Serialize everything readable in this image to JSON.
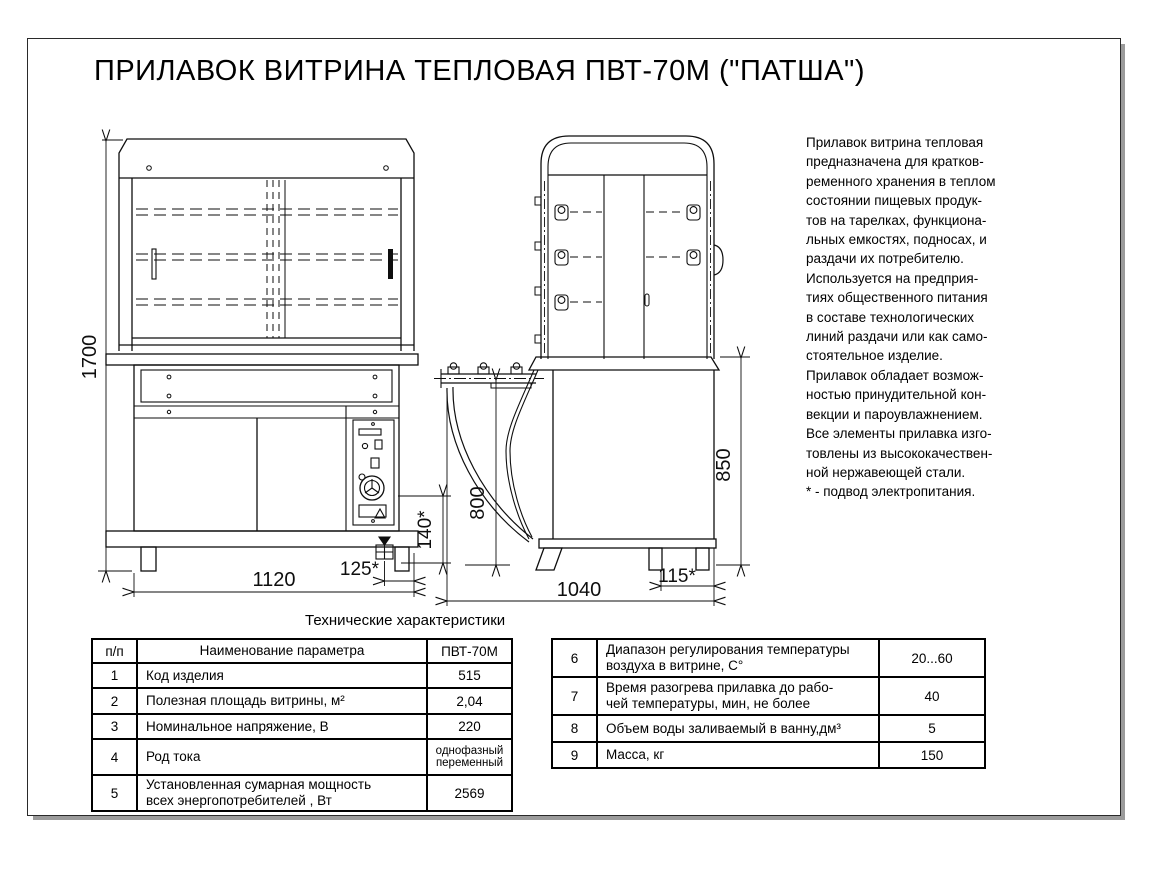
{
  "page": {
    "title": "ПРИЛАВОК ВИТРИНА ТЕПЛОВАЯ ПВТ-70М (\"ПАТША\")"
  },
  "description": {
    "text": "Прилавок витрина тепловая\nпредназначена для кратков-\nременного хранения в теплом\nсостоянии пищевых продук-\nтов на тарелках, функциона-\nльных емкостях, подносах, и\nраздачи их потребителю.\nИспользуется на предприя-\nтиях общественного питания\nв составе технологических\nлиний раздачи или как само-\nстоятельное изделие.\nПрилавок обладает возмож-\nностью принудительной кон-\nвекции и пароувлажнением.\nВсе элементы прилавка изго-\nтовлены из высококачествен-\nной нержавеющей стали.\n* - подвод электропитания."
  },
  "dimensions": {
    "front_height": "1700",
    "front_width": "1120",
    "front_elec_offset": "125*",
    "elec_height": "140*",
    "side_tray_height": "800",
    "side_counter_height": "850",
    "side_depth": "1040",
    "side_elec_offset": "115*"
  },
  "tables": {
    "caption": "Технические характеристики",
    "left": {
      "headers": {
        "num": "п/п",
        "name": "Наименование параметра",
        "value": "ПВТ-70М"
      },
      "rows": [
        {
          "num": "1",
          "name": "Код изделия",
          "value": "515"
        },
        {
          "num": "2",
          "name": "Полезная площадь витрины, м²",
          "value": "2,04"
        },
        {
          "num": "3",
          "name": "Номинальное напряжение, В",
          "value": "220"
        },
        {
          "num": "4",
          "name": "Род тока",
          "value": "однофазный переменный"
        },
        {
          "num": "5",
          "name": "Установленная сумарная мощность\nвсех энергопотребителей , Вт",
          "value": "2569"
        }
      ]
    },
    "right": {
      "rows": [
        {
          "num": "6",
          "name": "Диапазон регулирования температуры\nвоздуха в витрине, С°",
          "value": "20...60"
        },
        {
          "num": "7",
          "name": "Время разогрева прилавка до рабо-\nчей температуры, мин, не более",
          "value": "40"
        },
        {
          "num": "8",
          "name": "Объем воды заливаемый в ванну,дм³",
          "value": "5"
        },
        {
          "num": "9",
          "name": "Масса, кг",
          "value": "150"
        }
      ]
    }
  }
}
